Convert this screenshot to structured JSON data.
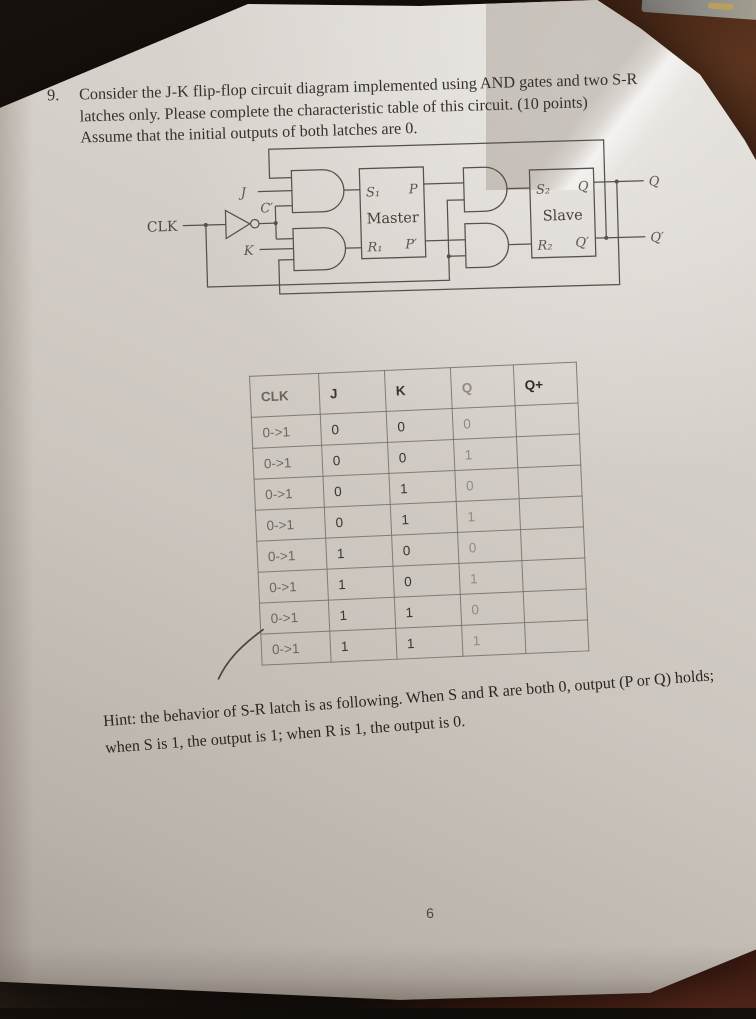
{
  "question": {
    "number": "9.",
    "line1": "Consider the J-K flip-flop circuit diagram implemented using AND gates and two S-R",
    "line2": "latches only. Please complete the characteristic table of this circuit. (10 points)",
    "line3": "Assume that the initial outputs of both latches are 0."
  },
  "circuit": {
    "clk": "CLK",
    "j": "J",
    "k": "K",
    "not_clk": "C′",
    "s1": "S₁",
    "p": "P",
    "master": "Master",
    "r1": "R₁",
    "p_prime": "P′",
    "s2": "S₂",
    "q": "Q",
    "slave": "Slave",
    "r2": "R₂",
    "q_prime": "Q′",
    "out_q": "Q",
    "out_q_prime": "Q′"
  },
  "table": {
    "headers": [
      "CLK",
      "J",
      "K",
      "Q",
      "Q+"
    ],
    "rows": [
      [
        "0->1",
        "0",
        "0",
        "0",
        ""
      ],
      [
        "0->1",
        "0",
        "0",
        "1",
        ""
      ],
      [
        "0->1",
        "0",
        "1",
        "0",
        ""
      ],
      [
        "0->1",
        "0",
        "1",
        "1",
        ""
      ],
      [
        "0->1",
        "1",
        "0",
        "0",
        ""
      ],
      [
        "0->1",
        "1",
        "0",
        "1",
        ""
      ],
      [
        "0->1",
        "1",
        "1",
        "0",
        ""
      ],
      [
        "0->1",
        "1",
        "1",
        "1",
        ""
      ]
    ]
  },
  "hint": {
    "line1": "Hint: the behavior of S-R latch is as following. When S and R are both 0, output (P or Q) holds;",
    "line2": "when S is 1, the output is 1; when R is 1, the output is 0."
  },
  "page_number": "6",
  "colors": {
    "paper": "#d2ccc6",
    "desk_dark": "#17110d",
    "desk_brown": "#5f3620",
    "desk_maroon": "#5a291c",
    "ink": "#35322c",
    "circuit_line": "#56514b",
    "table_line": "#6e685f",
    "pencil_gray": "#938a7c"
  }
}
